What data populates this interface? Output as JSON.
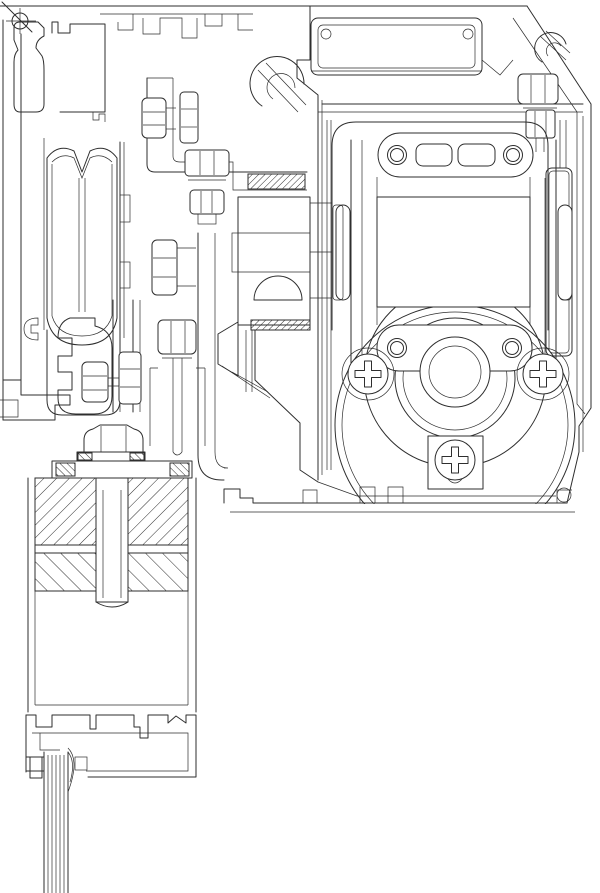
{
  "drawing": {
    "title": "cross-section technical drawing",
    "background_color": "#ffffff",
    "line_color": "#2e2e2e",
    "gasket_fill": "#000000",
    "components": [
      "corner-screw",
      "top-frame-profile",
      "left-wall-profile",
      "roller-wheel-carriage",
      "mounting-bracket-with-hex-bolts",
      "drive-cylinder",
      "countersunk-screw",
      "elbow-support-arm",
      "gear-housing-enclosure",
      "vent-plate",
      "hook-clips",
      "motor-gearbox-unit",
      "phillips-screws",
      "drive-wheel-circles",
      "leaf-clamp-bolt",
      "hatched-clamp-blocks",
      "door-leaf-profile",
      "bottom-rail-profile",
      "gasket-block",
      "brush-seal"
    ]
  }
}
